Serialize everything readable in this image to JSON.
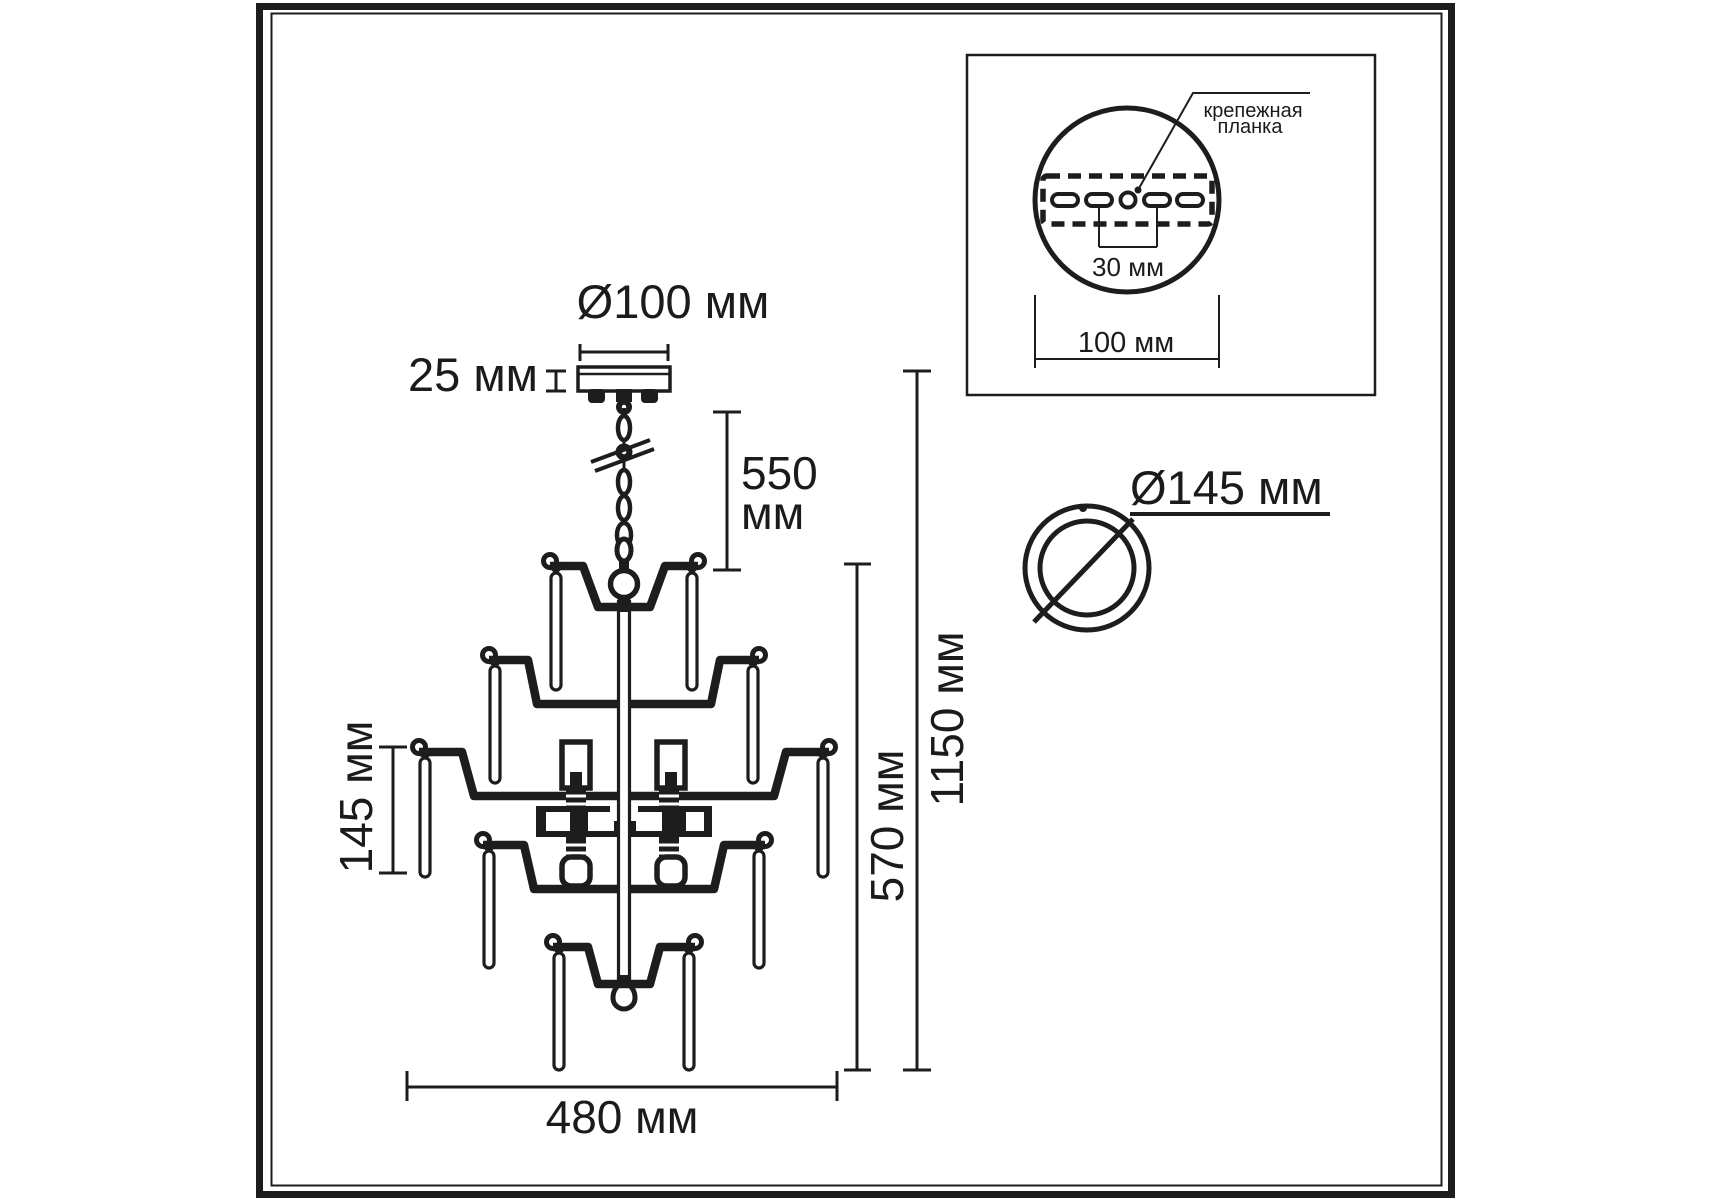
{
  "labels": {
    "canopy_diameter": "Ø100 мм",
    "canopy_height": "25 мм",
    "chain_length_value": "550",
    "chain_length_unit": "мм",
    "body_height": "570 мм",
    "total_height": "1150 мм",
    "pendant_length": "145 мм",
    "body_width": "480 мм",
    "ring_diameter": "Ø145 мм"
  },
  "inset": {
    "mounting_plate_line1": "крепежная",
    "mounting_plate_line2": "планка",
    "hole_spacing": "30 мм",
    "plate_width": "100 мм"
  }
}
